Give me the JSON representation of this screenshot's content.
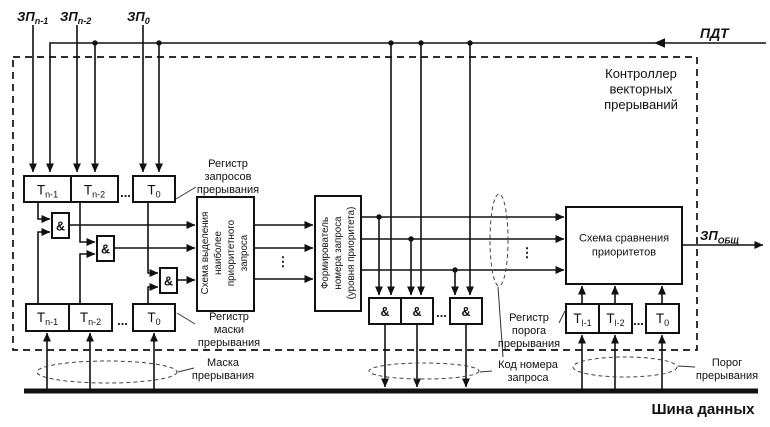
{
  "diagram": {
    "controller_title": [
      "Контроллер",
      "векторных",
      "прерываний"
    ],
    "bus_label": "Шина данных"
  },
  "io": {
    "zp_base": "ЗП",
    "zp_subs": [
      "n-1",
      "n-2",
      "0"
    ],
    "pdt": "ПДТ",
    "zp_out_base": "ЗП",
    "zp_out_sub": "ОБЩ"
  },
  "blocks": {
    "selector_lines": [
      "Схема выделения",
      "наиболее",
      "приоритетного",
      "запроса"
    ],
    "former_lines": [
      "Формирователь",
      "номера запроса",
      "(уровня приоритета)"
    ],
    "comparator_lines": [
      "Схема сравнения",
      "приоритетов"
    ],
    "and_label": "&"
  },
  "registers": {
    "t_base": "Т",
    "request_subs": [
      "n-1",
      "n-2",
      "0"
    ],
    "mask_subs": [
      "n-1",
      "n-2",
      "0"
    ],
    "threshold_subs": [
      "l-1",
      "l-2",
      "0"
    ],
    "ellipsis": "...",
    "vdots": "⋮"
  },
  "annotations": {
    "request_register": [
      "Регистр",
      "запросов",
      "прерывания"
    ],
    "mask_register": [
      "Регистр",
      "маски",
      "прерывания"
    ],
    "mask_bus": [
      "Маска",
      "прерывания"
    ],
    "code_bus": [
      "Код номера",
      "запроса"
    ],
    "threshold_register": [
      "Регистр",
      "порога",
      "прерывания"
    ],
    "threshold_bus": [
      "Порог",
      "прерывания"
    ]
  },
  "colors": {
    "ink": "#111111",
    "paper": "#ffffff"
  }
}
